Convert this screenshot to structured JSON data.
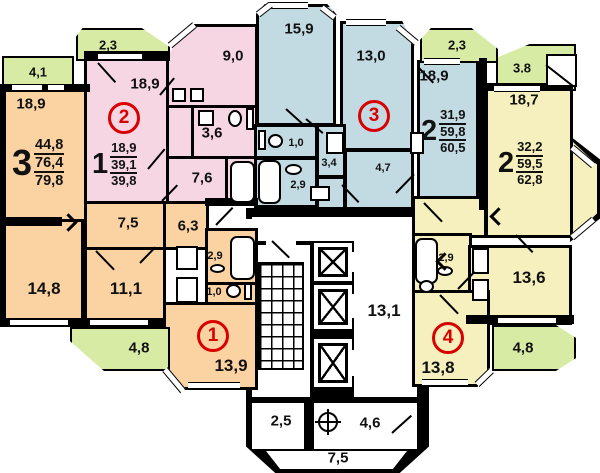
{
  "colors": {
    "apt1_orange": "#FBD3A3",
    "apt2_pink": "#F6D6E2",
    "apt3_blue": "#C2DAE2",
    "apt4_yellow": "#F5F0BD",
    "balcony_green": "#D7EBA5",
    "accent_red": "#D90000",
    "wall_black": "#000000"
  },
  "apartments": {
    "apt1": {
      "number": "1",
      "rooms_type": "3",
      "areas": {
        "living": "44,8",
        "usable": "76,4",
        "total": "79,8"
      },
      "labels": {
        "room_a": "18,9",
        "room_b": "14,8",
        "room_c": "11,1",
        "kitchen": "13,9",
        "corridor": "7,5",
        "hall": "6,3",
        "bath": "2,9",
        "wc": "1,0",
        "balcony_a": "4,1",
        "balcony_b": "4,8"
      }
    },
    "apt2": {
      "number": "2",
      "rooms_type": "1",
      "areas": {
        "living": "18,9",
        "usable": "39,1",
        "total": "39,8"
      },
      "labels": {
        "room_a": "18,9",
        "kitchen": "9,0",
        "bath": "3,6",
        "corridor": "7,6",
        "balcony_a": "2,3"
      }
    },
    "apt3": {
      "number": "3",
      "rooms_type": "2",
      "areas": {
        "living": "31,9",
        "usable": "59,8",
        "total": "60,5"
      },
      "labels": {
        "room_a": "15,9",
        "room_b": "13,0",
        "room_c": "18,9",
        "wc": "1,0",
        "corridor": "3,4",
        "bath": "2,9",
        "hall": "4,7",
        "balcony_a": "2,3"
      }
    },
    "apt4": {
      "number": "4",
      "rooms_type": "2",
      "areas": {
        "living": "32,2",
        "usable": "59,5",
        "total": "62,8"
      },
      "labels": {
        "room_a": "18,7",
        "room_b": "13,6",
        "kitchen": "13,8",
        "bath": "2,9",
        "balcony_a": "3.8",
        "balcony_b": "4,8"
      }
    }
  },
  "core": {
    "hall": "13,1",
    "vestibule": "2,5",
    "refuse_chute": "4,6",
    "entrance": "7,5"
  }
}
